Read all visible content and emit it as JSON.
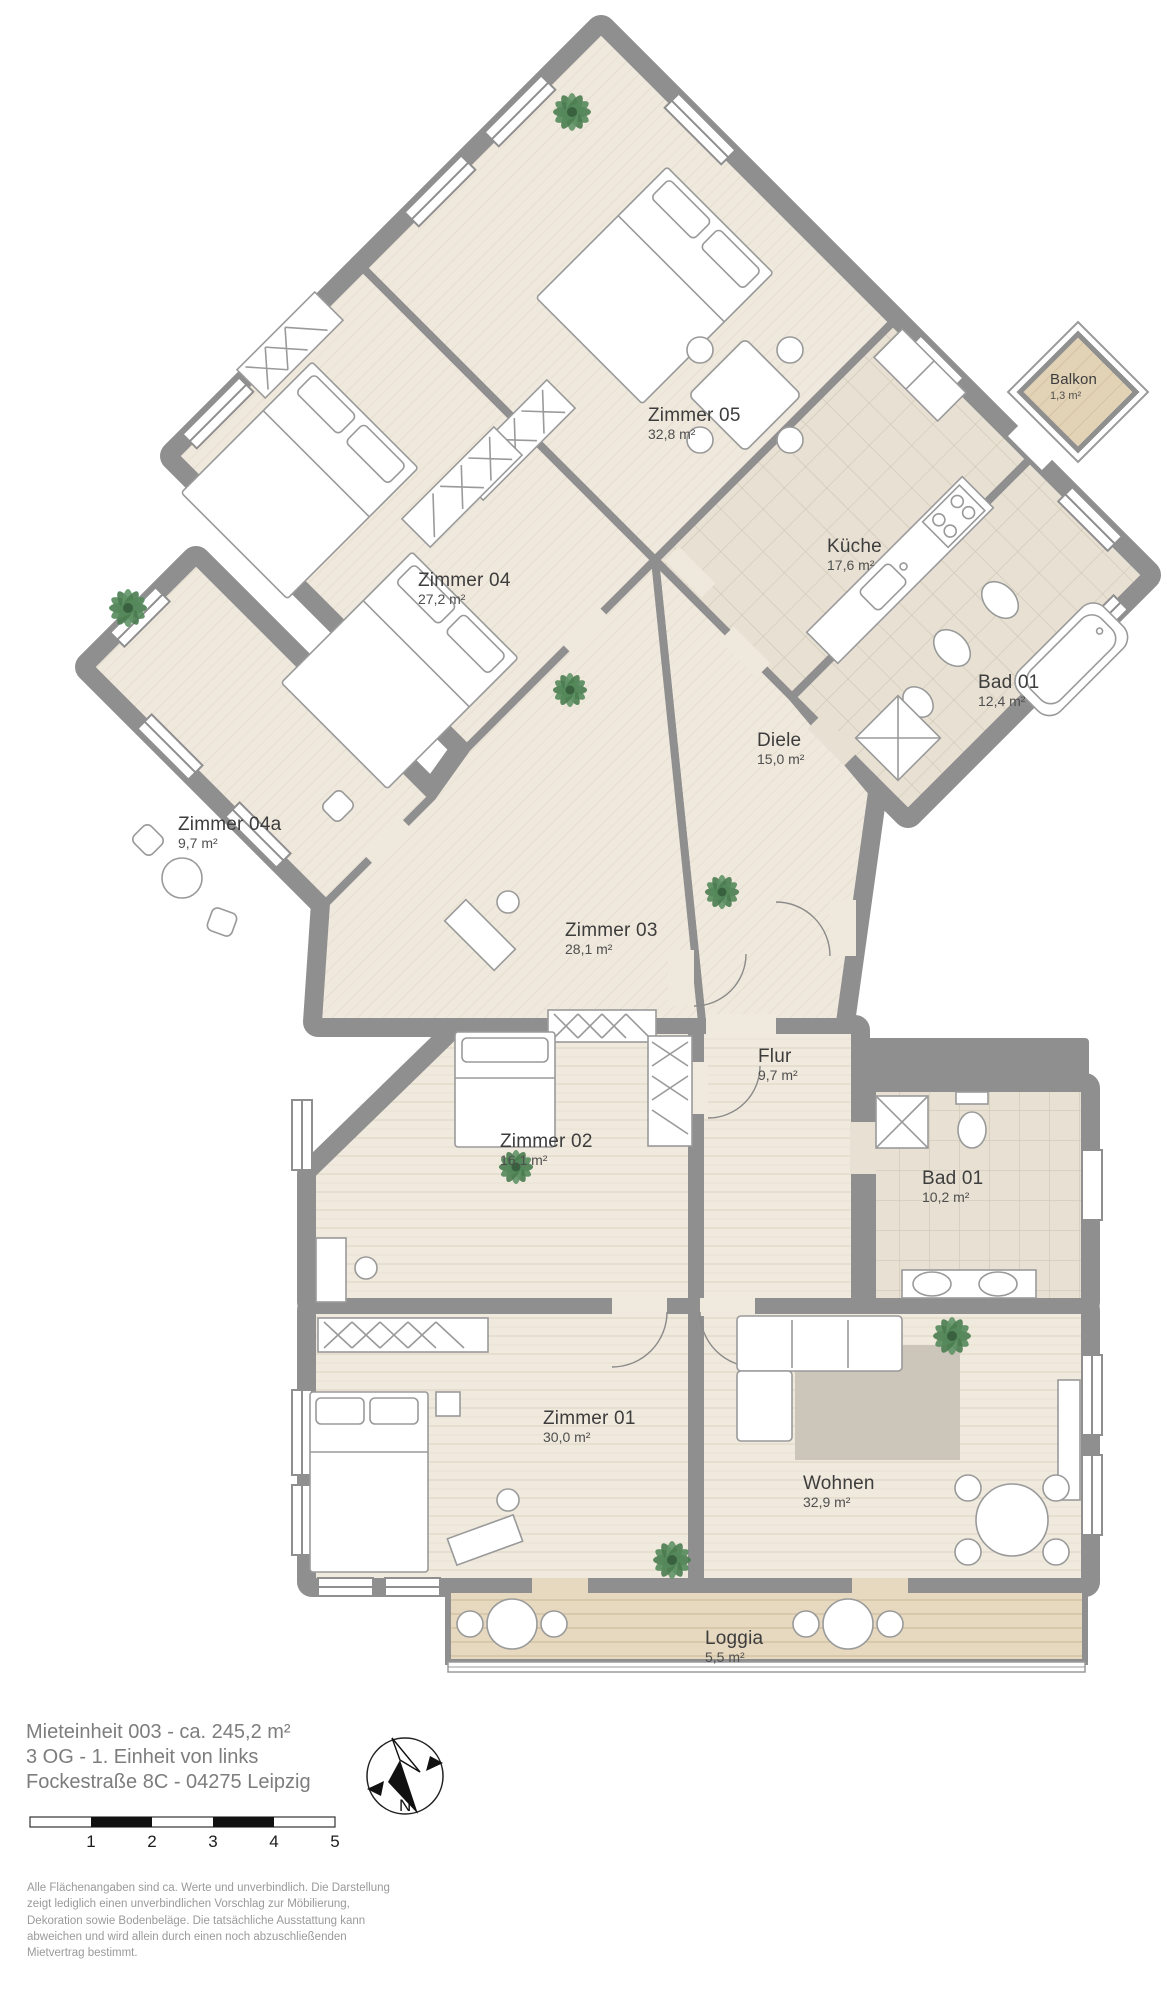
{
  "title_block": {
    "line1": "Mieteinheit 003 - ca. 245,2 m²",
    "line2": "3 OG - 1. Einheit von links",
    "line3": "Fockestraße 8C - 04275 Leipzig"
  },
  "rooms": [
    {
      "name": "Zimmer 05",
      "area": "32,8 m²"
    },
    {
      "name": "Küche",
      "area": "17,6 m²"
    },
    {
      "name": "Balkon",
      "area": "1,3 m²"
    },
    {
      "name": "Bad 01",
      "area": "12,4 m²"
    },
    {
      "name": "Diele",
      "area": "15,0 m²"
    },
    {
      "name": "Zimmer 04",
      "area": "27,2 m²"
    },
    {
      "name": "Zimmer 04a",
      "area": "9,7 m²"
    },
    {
      "name": "Zimmer 03",
      "area": "28,1 m²"
    },
    {
      "name": "Flur",
      "area": "9,7 m²"
    },
    {
      "name": "Zimmer 02",
      "area": "16,1 m²"
    },
    {
      "name": "Bad 01",
      "area": "10,2 m²"
    },
    {
      "name": "Zimmer 01",
      "area": "30,0 m²"
    },
    {
      "name": "Wohnen",
      "area": "32,9 m²"
    },
    {
      "name": "Loggia",
      "area": "5,5 m²"
    }
  ],
  "compass": {
    "north_label": "N"
  },
  "scale_bar": {
    "ticks": [
      "1",
      "2",
      "3",
      "4",
      "5"
    ]
  },
  "disclaimer": {
    "lines": [
      "Alle Flächenangaben sind ca. Werte und unverbindlich. Die Darstellung",
      "zeigt lediglich einen unverbindlichen Vorschlag zur Möbilierung,",
      "Dekoration sowie Bodenbeläge. Die tatsächliche Ausstattung kann",
      "abweichen und wird allein durch einen noch abzuschließenden",
      "Mietvertrag bestimmt."
    ]
  },
  "colors": {
    "wall": "#8f8f8f",
    "floor_wood": "#efe8dc",
    "floor_tile": "#e8e1d3",
    "deck": "#e6d9c0",
    "plant": "#4a7c50",
    "rug": "#ccc5ba"
  }
}
